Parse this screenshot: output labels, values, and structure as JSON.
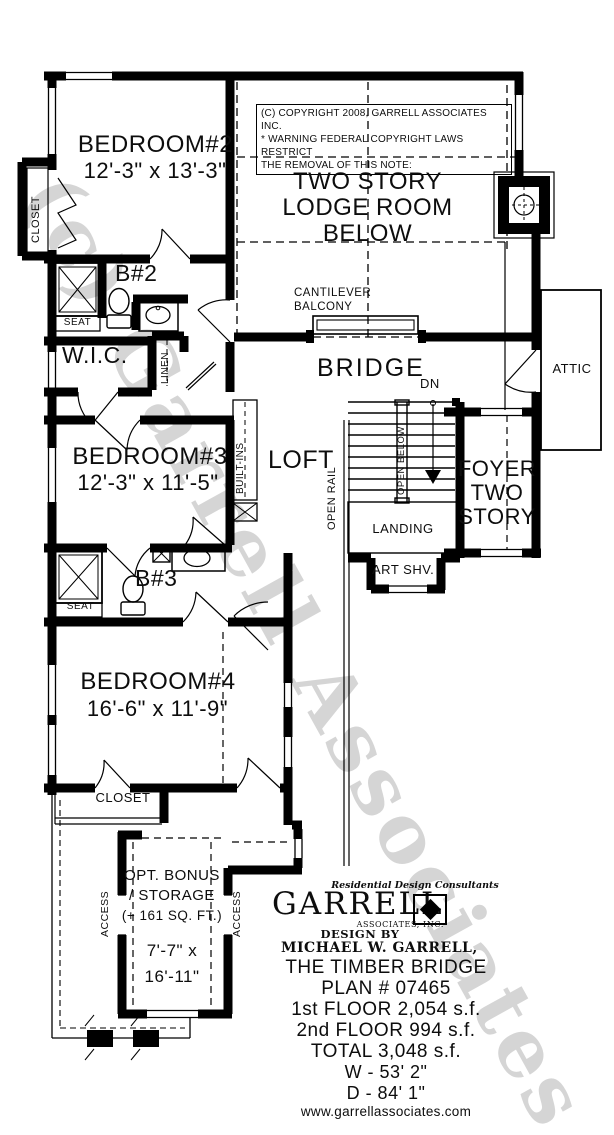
{
  "watermark": "(c) Garrell Associates",
  "copyright_box": {
    "line1": "(C) COPYRIGHT 2008, GARRELL ASSOCIATES INC.",
    "line2": "* WARNING FEDERAL COPYRIGHT LAWS RESTRICT",
    "line3": "THE REMOVAL OF THIS NOTE:"
  },
  "rooms": {
    "bedroom2": {
      "name": "BEDROOM#2",
      "dims": "12'-3\" x 13'-3\""
    },
    "lodge": {
      "line1": "TWO STORY",
      "line2": "LODGE ROOM",
      "line3": "BELOW"
    },
    "bath2": "B#2",
    "wic": "W.I.C.",
    "bridge": "BRIDGE",
    "attic": "ATTIC",
    "loft": "LOFT",
    "bedroom3": {
      "name": "BEDROOM#3",
      "dims": "12'-3\" x 11'-5\""
    },
    "foyer": {
      "line1": "FOYER",
      "line2": "TWO",
      "line3": "STORY"
    },
    "bath3": "B#3",
    "bedroom4": {
      "name": "BEDROOM#4",
      "dims": "16'-6\" x 11'-9\""
    },
    "bonus": {
      "line1": "OPT. BONUS",
      "line2": "/ STORAGE",
      "line3": "(+ 161 SQ. FT.)",
      "dims1": "7'-7\" x",
      "dims2": "16'-11\""
    }
  },
  "labels": {
    "closet_b2": "CLOSET",
    "seat_b2": "SEAT",
    "linen": "LINEN",
    "cantilever1": "CANTILEVER",
    "cantilever2": "BALCONY",
    "dn": "DN",
    "open_below": "OPEN BELOW",
    "open_rail": "OPEN RAIL",
    "landing": "LANDING",
    "art_shv": "ART SHV.",
    "built_ins": "BUILT-INS",
    "seat_b3": "SEAT",
    "closet_b4": "CLOSET",
    "access_left": "ACCESS",
    "access_right": "ACCESS"
  },
  "logo": {
    "tagline": "Residential Design Consultants",
    "name": "GARRELL",
    "sub": "ASSOCIATES, INC.",
    "design_by1": "DESIGN BY",
    "design_by2": "MICHAEL W. GARRELL,"
  },
  "plan_info": {
    "title": "THE TIMBER BRIDGE",
    "plan": "PLAN # 07465",
    "floor1": "1st FLOOR 2,054 s.f.",
    "floor2": "2nd FLOOR 994 s.f.",
    "total": "TOTAL 3,048 s.f.",
    "width": "W - 53'  2\"",
    "depth": "D - 84'  1\"",
    "website": "www.garrellassociates.com"
  }
}
